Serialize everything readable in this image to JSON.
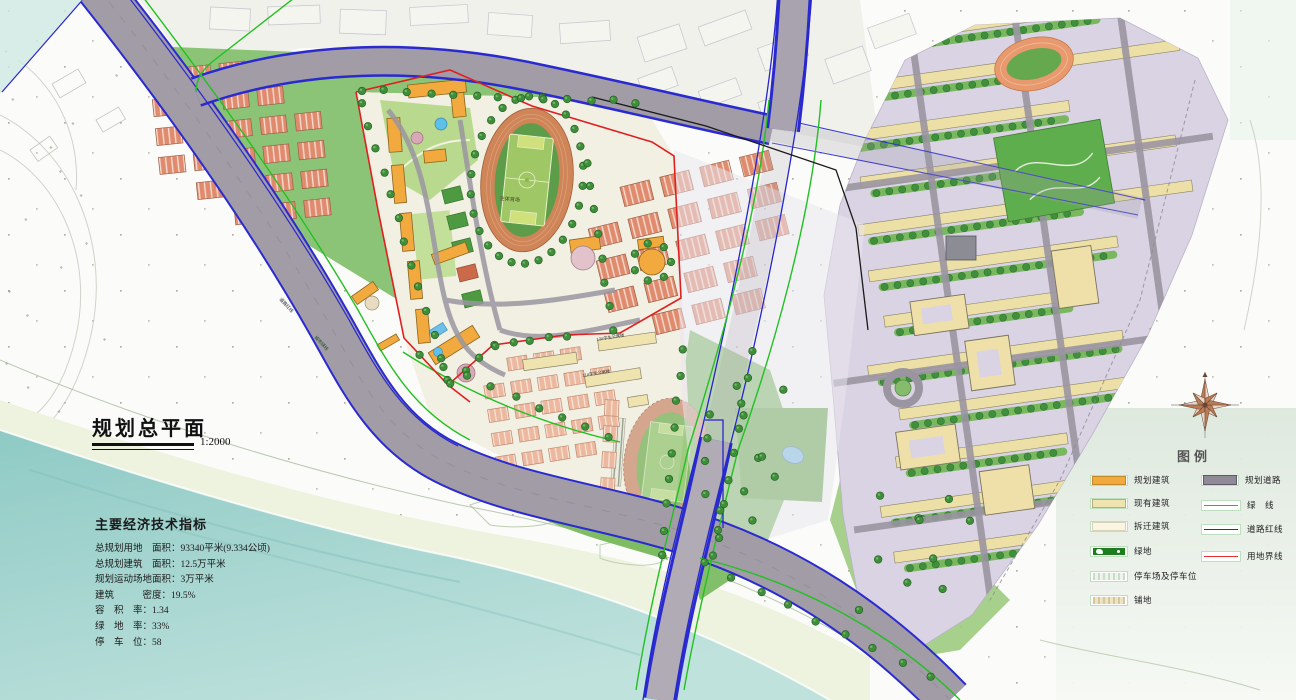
{
  "title": {
    "text": "规划总平面",
    "scale": "1:2000"
  },
  "indicators": {
    "heading": "主要经济技术指标",
    "lines": [
      "总规划用地　面积：93340平米(9.334公顷)",
      "总规划建筑　面积：12.5万平米",
      "规划运动场地面积：3万平米",
      "建筑　　　密度：19.5%",
      "容　积　率：1.34",
      "绿　地　率：33%",
      "停　车　位：58"
    ]
  },
  "legend": {
    "title": "图例",
    "left": [
      {
        "label": "规划建筑"
      },
      {
        "label": "现有建筑"
      },
      {
        "label": "拆迁建筑"
      },
      {
        "label": "绿地"
      },
      {
        "label": "停车场及停车位"
      },
      {
        "label": "铺地"
      }
    ],
    "right": [
      {
        "label": "规划道路"
      },
      {
        "label": "绿　线"
      },
      {
        "label": "道路红线"
      },
      {
        "label": "用地界线"
      }
    ]
  },
  "map_labels": {
    "stadium": "主体育场",
    "dorm_12": "12#学生公寓楼",
    "dorm_11": "11#学生公寓楼",
    "road_red_line": "道路红线",
    "city_green_line": "城市绿线"
  },
  "colors": {
    "planned_building": "#f3a93d",
    "existing_building": "#efe3b0",
    "demolish_building": "#fbf6e4",
    "green_space": "#1e7d1e",
    "planned_road": "#8f8a96",
    "green_line": "#22c022",
    "road_red_line_color": "#2626cc",
    "land_boundary": "#e02020",
    "water": "#a5d6d1"
  }
}
